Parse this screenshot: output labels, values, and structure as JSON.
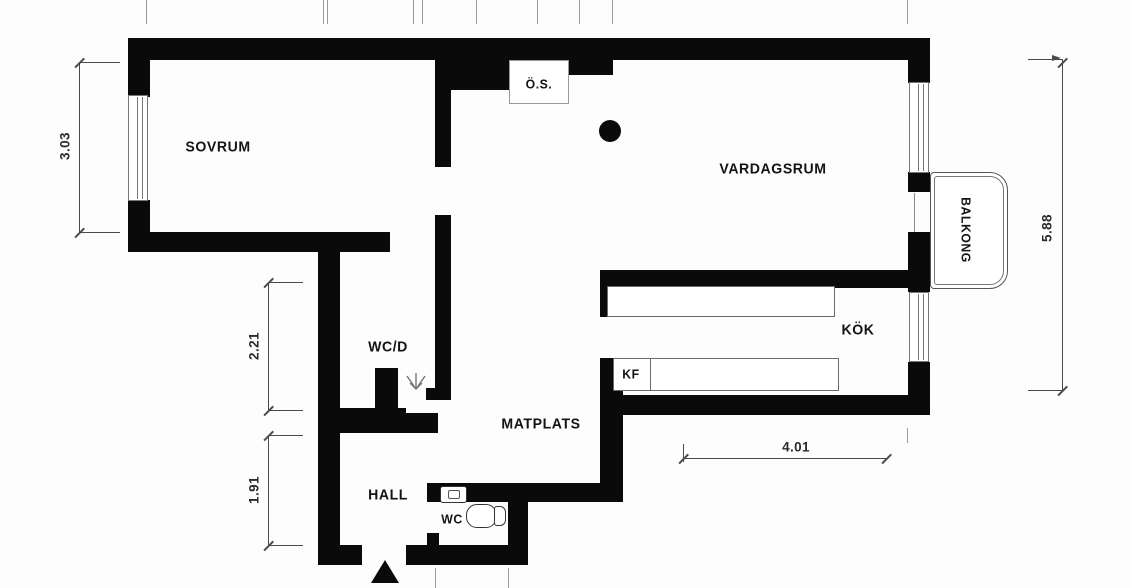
{
  "plan_title": "apartment floor plan",
  "rooms": {
    "sovrum": "SOVRUM",
    "vardagsrum": "VARDAGSRUM",
    "kok": "KÖK",
    "wcd": "WC/D",
    "matplats": "MATPLATS",
    "hall": "HALL",
    "wc": "WC",
    "balkong": "BALKONG"
  },
  "features": {
    "os": "Ö.S.",
    "kf": "KF"
  },
  "dimensions": {
    "bedroom_height": "3.03",
    "wcd_height": "2.21",
    "hall_height": "1.91",
    "right_side_height": "5.88",
    "kitchen_width": "4.01"
  },
  "colors": {
    "wall": "#0a0a0a",
    "fixture_outline": "#6b6b6b",
    "dimension_line": "#4a4a4a",
    "background": "#ffffff"
  }
}
